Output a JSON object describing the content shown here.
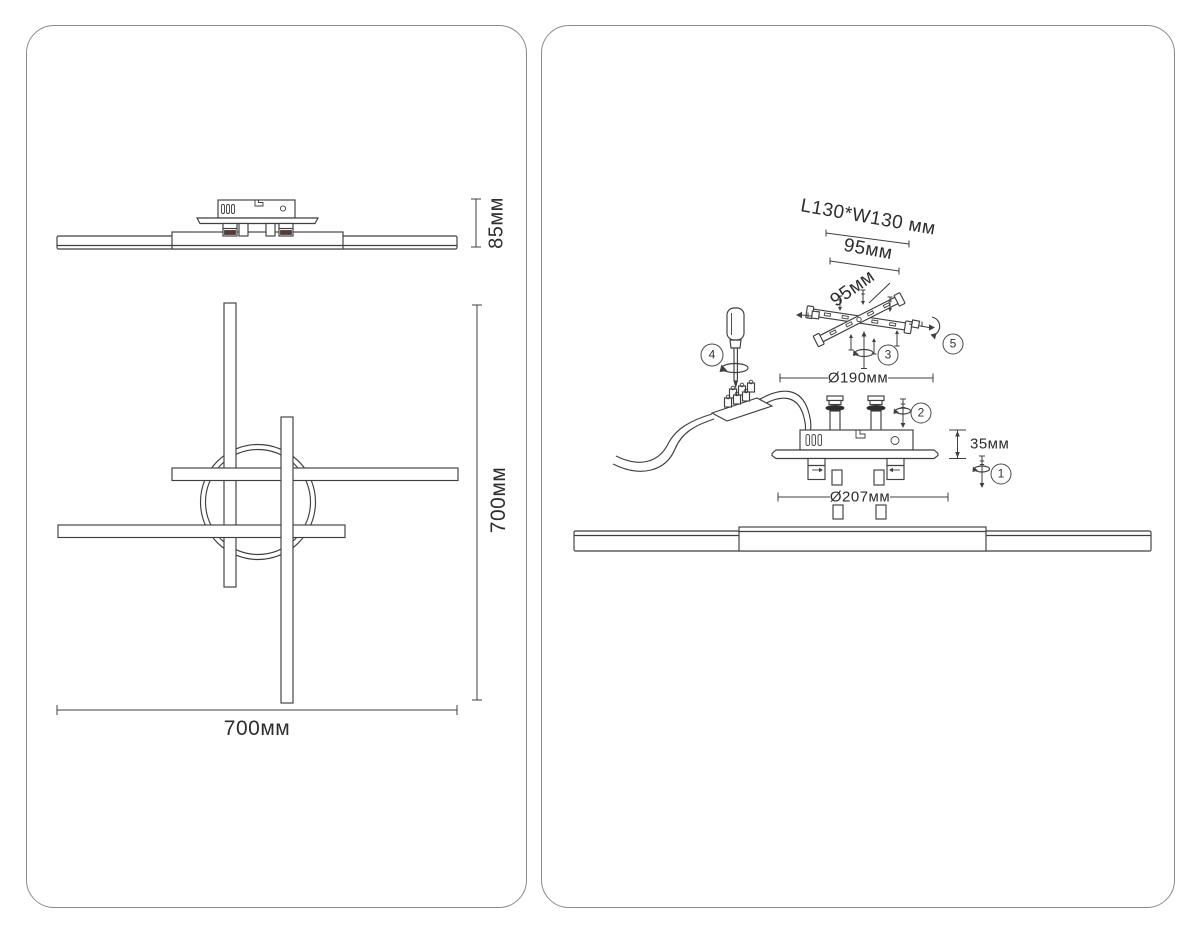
{
  "palette": {
    "background": "#ffffff",
    "line": "#3f3f3f",
    "panel_border": "#8b8b8b",
    "text": "#2d2d2d",
    "clip_accent": "#5c3733",
    "washer_fill": "#2e2e2e"
  },
  "left_panel": {
    "side_view": {
      "height_dim": "85мм"
    },
    "plan_view": {
      "width_dim": "700мм",
      "height_dim": "700мм"
    }
  },
  "right_panel": {
    "dims": {
      "mount_plate_size": "L130*W130 мм",
      "screw_spacing_a": "95мм",
      "screw_spacing_b": "95мм",
      "canopy_diameter": "Ø190мм",
      "canopy_height": "35мм",
      "base_diameter": "Ø207мм"
    },
    "steps": [
      "1",
      "2",
      "3",
      "4",
      "5"
    ]
  }
}
